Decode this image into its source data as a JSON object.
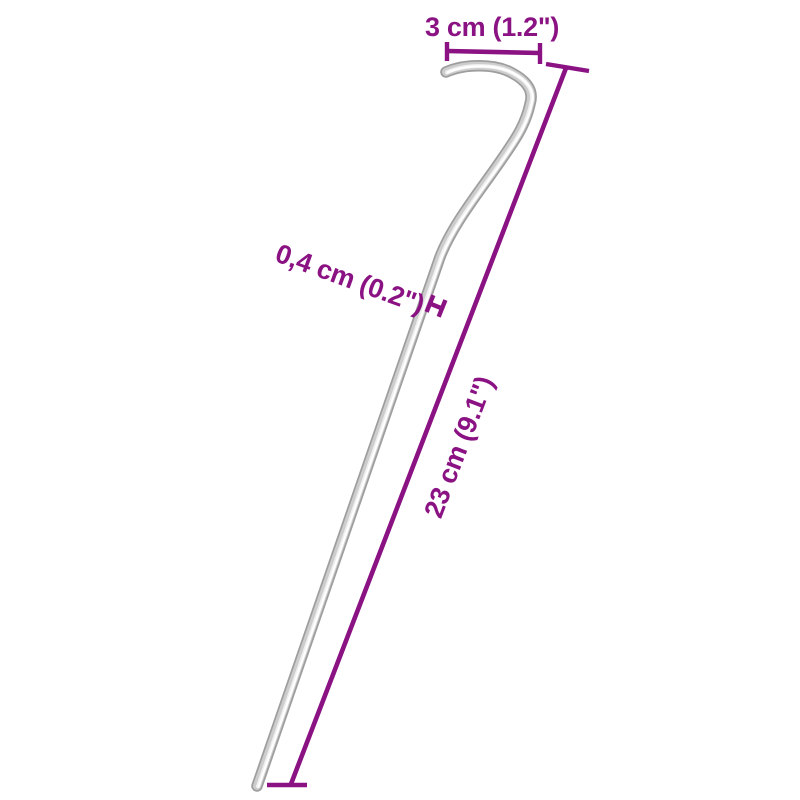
{
  "page": {
    "type": "product dimension diagram",
    "subject": "steel tent peg with hook",
    "background": "#ffffff"
  },
  "colors": {
    "dimension": "#8A1283",
    "peg_base": "#9e9e9e",
    "peg_mid": "#cdcdcd",
    "peg_light": "#efefef",
    "peg_highlight": "#ffffff"
  },
  "labels": {
    "hook_width": "3 cm (1.2\")",
    "diameter": "0,4 cm (0.2\")",
    "length": "23 cm (9.1\")"
  },
  "measurements": {
    "hook_width_cm": "3",
    "hook_width_in": "1.2",
    "diameter_cm": "0,4",
    "diameter_in": "0.2",
    "length_cm": "23",
    "length_in": "9.1"
  }
}
